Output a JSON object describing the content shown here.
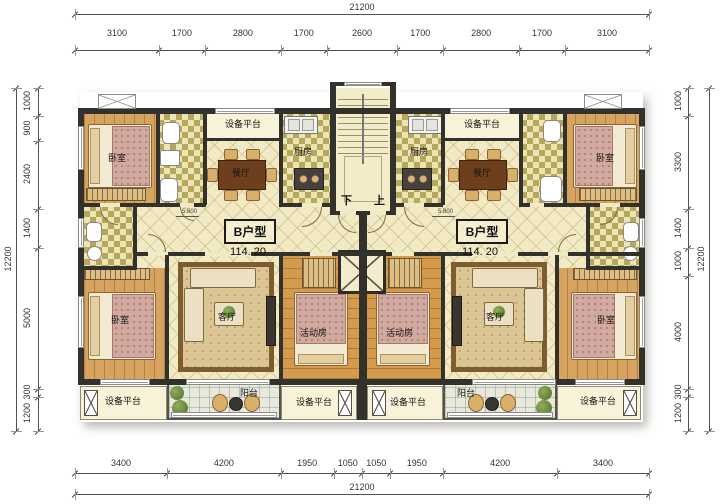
{
  "labels": {
    "bedroom": "卧室",
    "dining": "餐厅",
    "kitchen": "厨房",
    "living": "客厅",
    "activity": "活动房",
    "balcony": "阳台",
    "equipment_platform": "设备平台",
    "stairs_down": "下",
    "stairs_up": "上",
    "elevation": "5.800"
  },
  "units": {
    "left": {
      "type_name": "B户型",
      "area": "114. 20"
    },
    "right": {
      "type_name": "B户型",
      "area": "114. 20"
    }
  },
  "dimensions": {
    "top": {
      "total": "21200",
      "segments": [
        "3100",
        "1700",
        "2800",
        "1700",
        "2600",
        "1700",
        "2800",
        "1700",
        "3100"
      ]
    },
    "bottom": {
      "total": "21200",
      "segments": [
        "3400",
        "4200",
        "1950",
        "1050",
        "1050",
        "1950",
        "4200",
        "3400"
      ]
    },
    "left": {
      "total": "12200",
      "segments": [
        "1000",
        "900",
        "2400",
        "1400",
        "5000",
        "300",
        "1200"
      ]
    },
    "right": {
      "total": "12200",
      "segments": [
        "1000",
        "3300",
        "1400",
        "1000",
        "4000",
        "300",
        "1200"
      ]
    }
  },
  "colors": {
    "wall": "#33312c",
    "tile_floor": "#f2e9c5",
    "wood_floor": "#d7a45f",
    "checker_accent": "#b5a75b",
    "balcony_floor": "#e7e9dc",
    "platform": "#f8f2d9"
  }
}
